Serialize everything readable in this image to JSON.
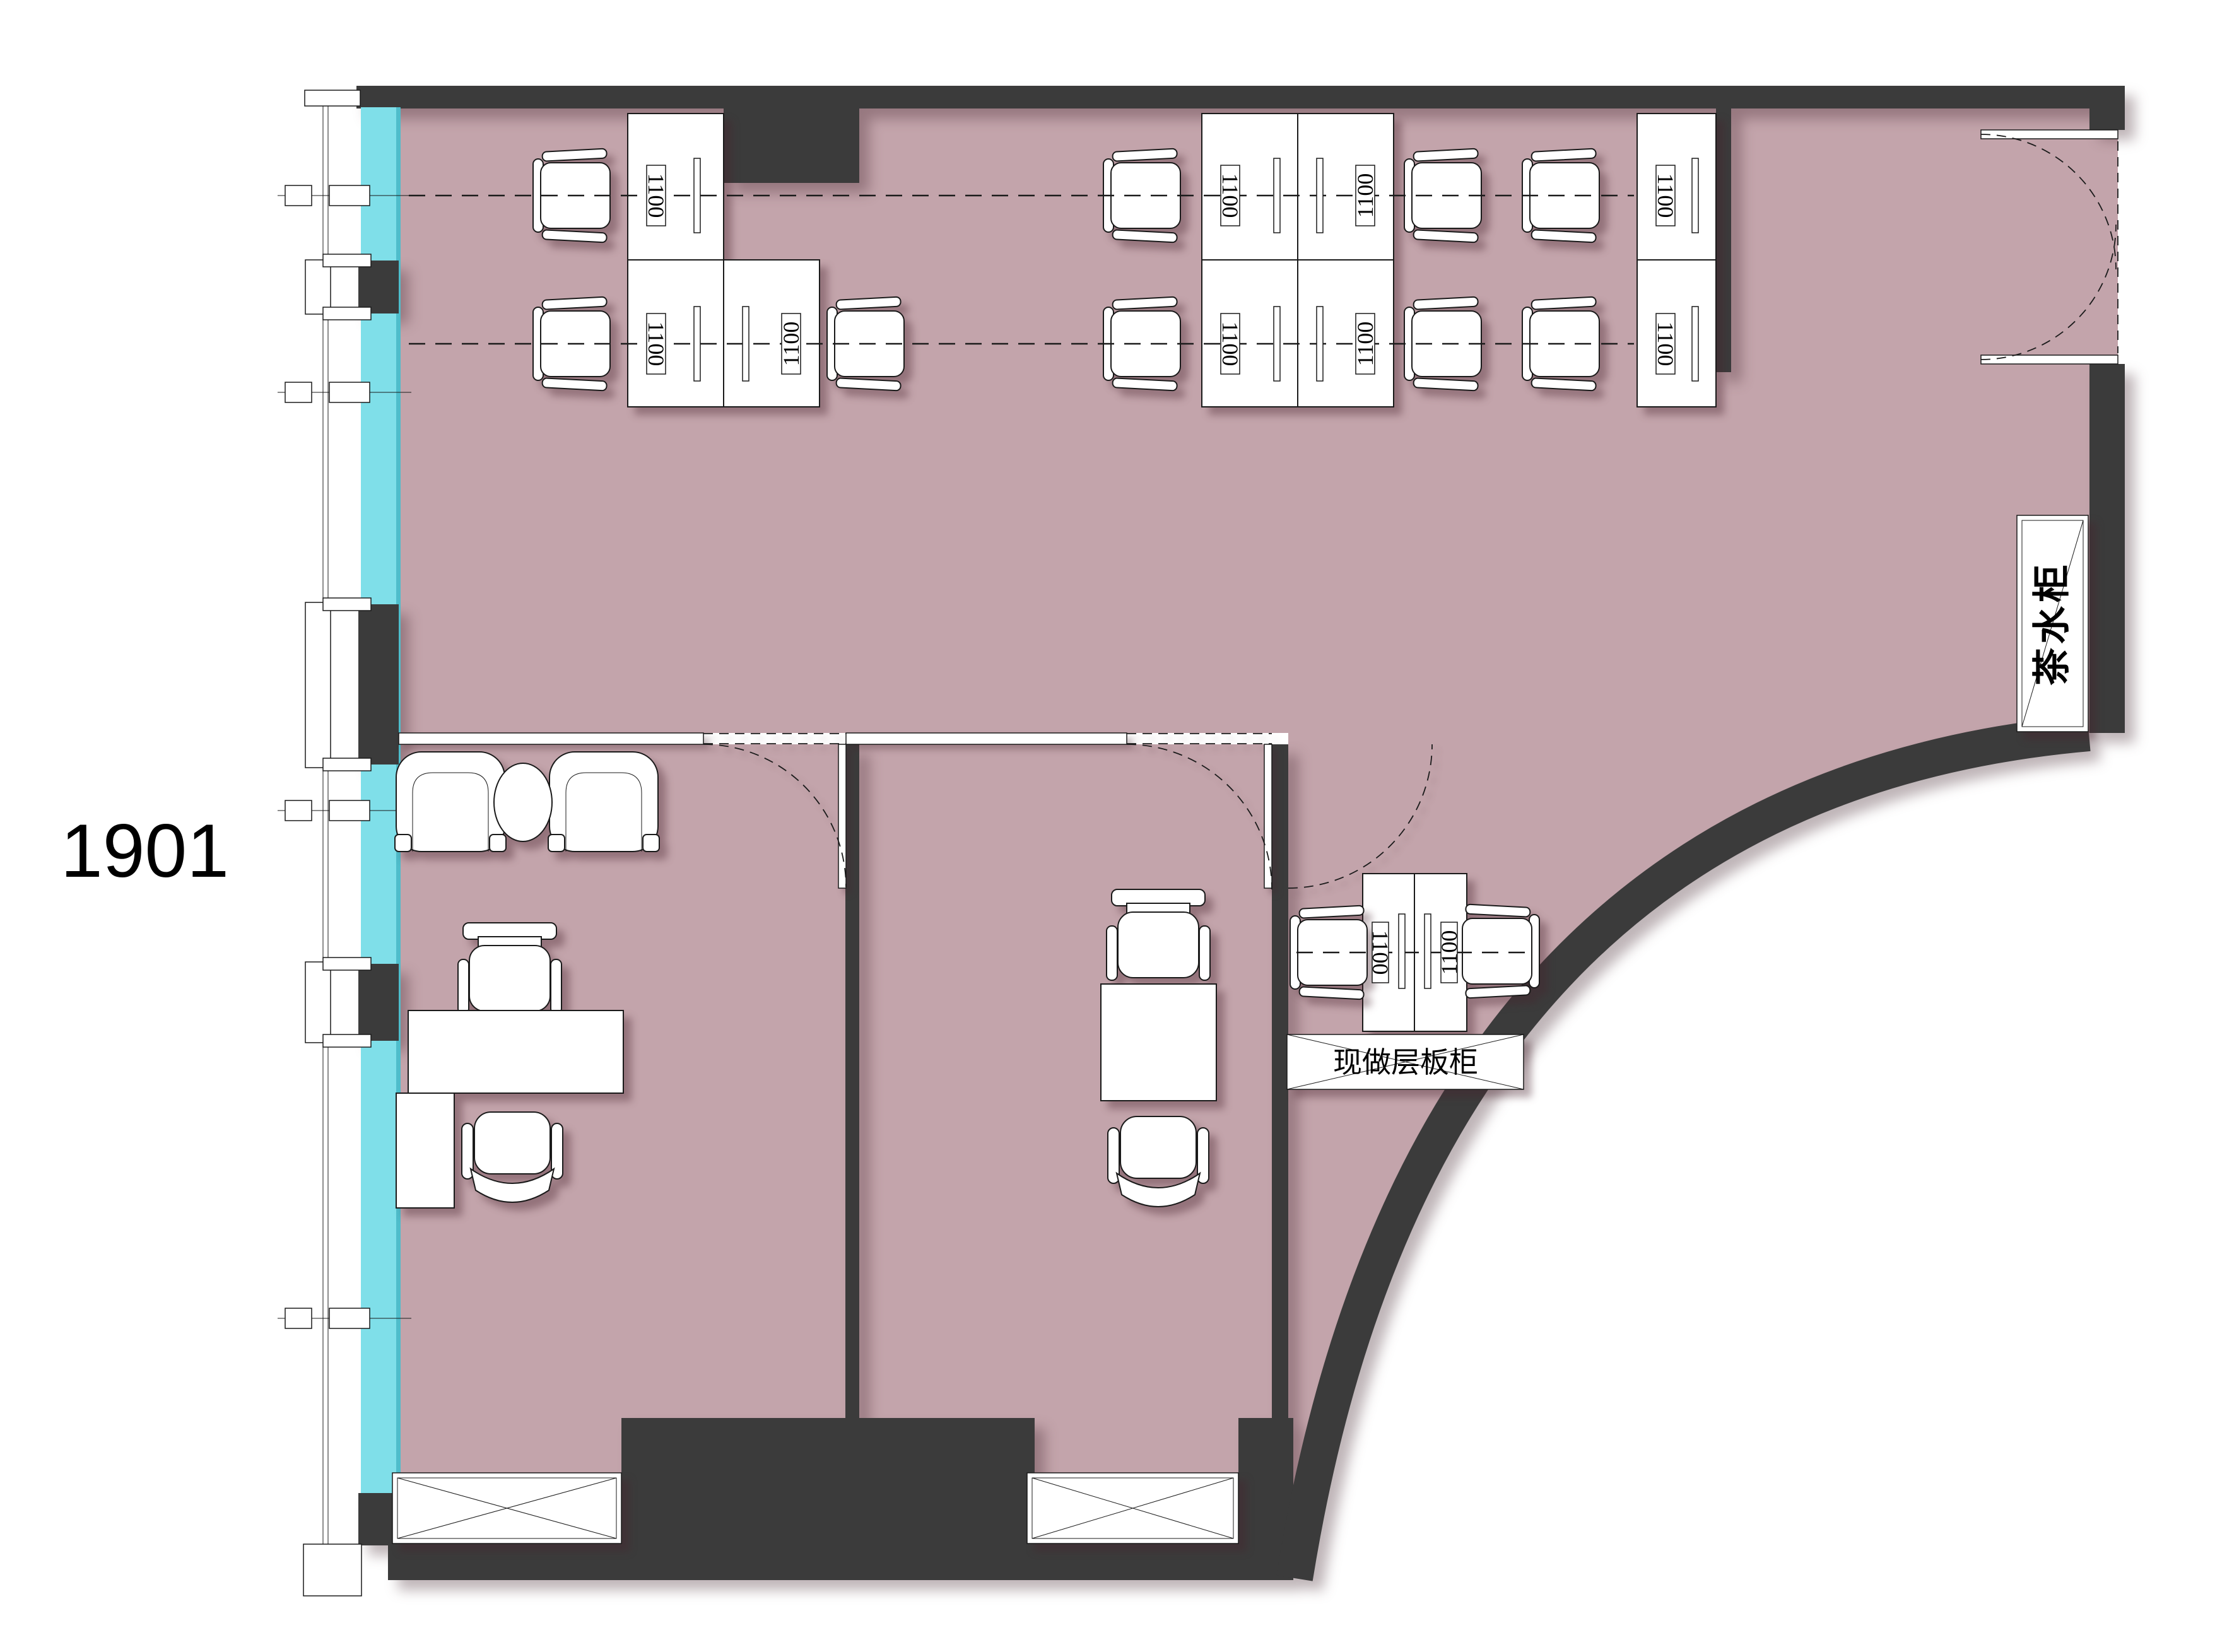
{
  "plan": {
    "unit_label": "1901",
    "tea_cabinet_label": "茶水柜",
    "shelf_label": "现做层板柜",
    "desk_labels": [
      "1100",
      "1100",
      "1100",
      "1100",
      "1100",
      "1100",
      "1100",
      "1100",
      "1100",
      "1100",
      "1100"
    ],
    "colors": {
      "page": "#ffffff",
      "floor": "#c3a4ab",
      "glass": "#7fdfe9",
      "wall": "#3b3b3b",
      "furniture": "#ffffff",
      "outline": "#1a1a1a"
    }
  }
}
